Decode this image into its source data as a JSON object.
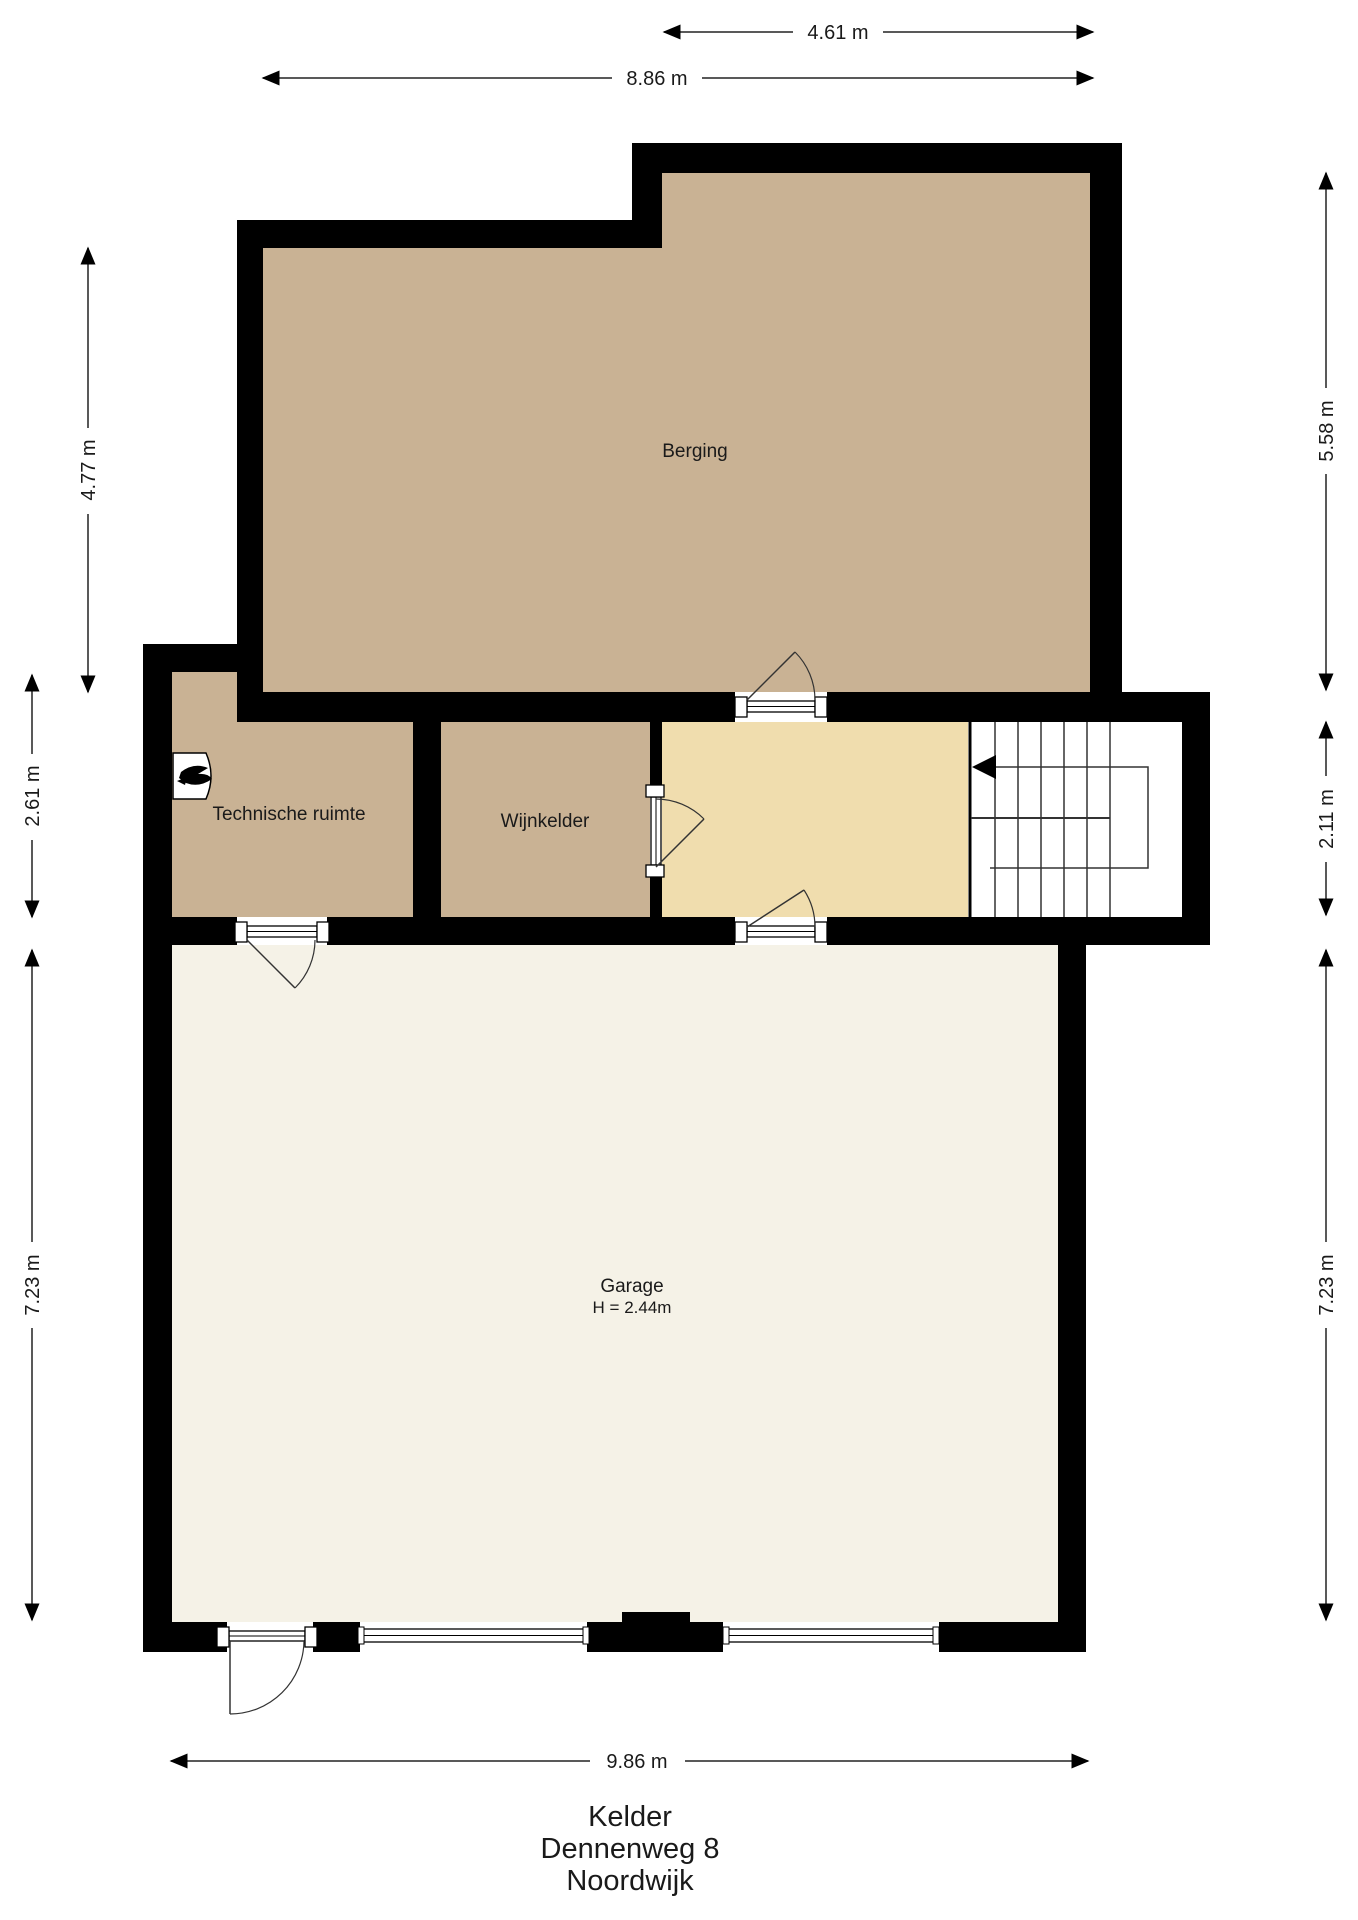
{
  "plan": {
    "title_block": {
      "floor": "Kelder",
      "street": "Dennenweg 8",
      "city": "Noordwijk"
    },
    "rooms": {
      "berging": {
        "label": "Berging"
      },
      "technische_ruimte": {
        "label": "Technische ruimte"
      },
      "wijnkelder": {
        "label": "Wijnkelder"
      },
      "garage": {
        "label": "Garage",
        "ceiling_height": "H = 2.44m"
      }
    },
    "dimensions": {
      "top_partial": "4.61 m",
      "top_full": "8.86 m",
      "left_upper": "4.77 m",
      "left_middle": "2.61 m",
      "left_lower": "7.23 m",
      "right_upper": "5.58 m",
      "right_middle": "2.11 m",
      "right_lower": "7.23 m",
      "bottom": "9.86 m"
    },
    "icons": {
      "boiler": "boiler-icon",
      "stairs_arrow": "stairs-direction-arrow"
    },
    "colors": {
      "wall": "#000000",
      "room_tan": "#c9b294",
      "hall_cream": "#f0ddae",
      "garage_cream": "#f5f2e7",
      "stairwell": "#ffffff",
      "background": "#ffffff",
      "dim_line": "#222222"
    }
  }
}
